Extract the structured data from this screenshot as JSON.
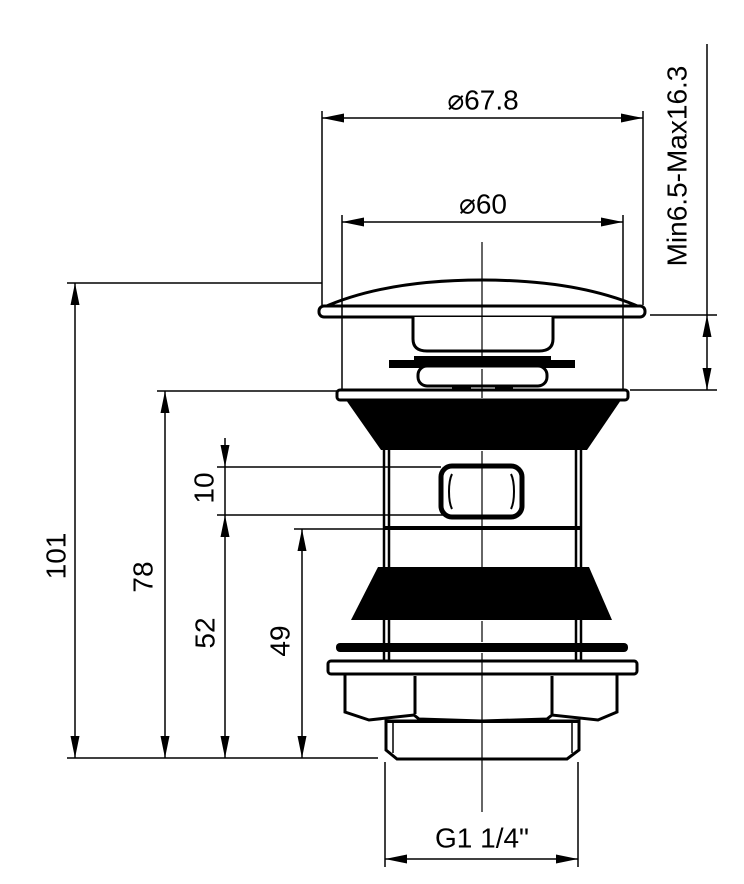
{
  "drawing": {
    "title": "Pop-up basin waste valve - dimensioned front elevation",
    "units": "mm",
    "colors": {
      "line": "#000000",
      "background": "#ffffff"
    },
    "labels": {
      "cap_diameter": "⌀67.8",
      "flange_diameter": "⌀60",
      "mounting_range": "Min6.5-Max16.3",
      "overall_height": "101",
      "body_height": "78",
      "overflow_height": "10",
      "lower_height_52": "52",
      "lower_height_49": "49",
      "thread_size": "G1 1/4\""
    }
  }
}
